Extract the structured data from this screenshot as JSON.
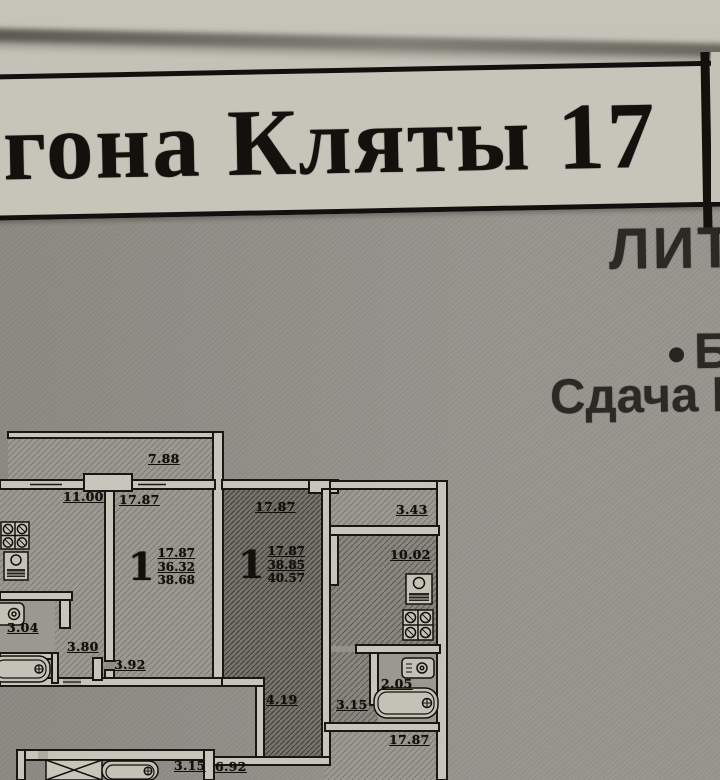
{
  "banner": {
    "title_fragment": "гона Кляты 17"
  },
  "side_annotations": {
    "line1": "ЛИТ",
    "line2": "Б",
    "line3": "Сдача К"
  },
  "floor_plan": {
    "apartments": [
      {
        "rooms_label": "1",
        "living_area": "17.87",
        "area": "36.32",
        "total_area": "38.68",
        "room_width": "17.87"
      },
      {
        "rooms_label": "1",
        "living_area": "17.87",
        "area": "38.85",
        "total_area": "40.57",
        "room_width": "17.87"
      }
    ],
    "dimensions": {
      "balcony": "7.88",
      "left_room": "11.00",
      "right_strip": "3.43",
      "kitchen": "10.02",
      "left_sink": "3.04",
      "left_hall_a": "3.80",
      "left_hall_b": "3.92",
      "hallway": "4.19",
      "right_hall": "3.15",
      "right_bath": "2.05",
      "bottom_room": "17.87",
      "bottom_a": "3.15",
      "bottom_b": "6.92"
    },
    "icons": [
      "burner-grid-icon",
      "stove-icon",
      "sink-icon",
      "bathtub-icon",
      "elevator-icon"
    ],
    "colors": {
      "wall_fill": "#eeebdd",
      "line": "#1d1b15",
      "dark_room": "#8e8c82",
      "paper": "#edebdd"
    }
  }
}
